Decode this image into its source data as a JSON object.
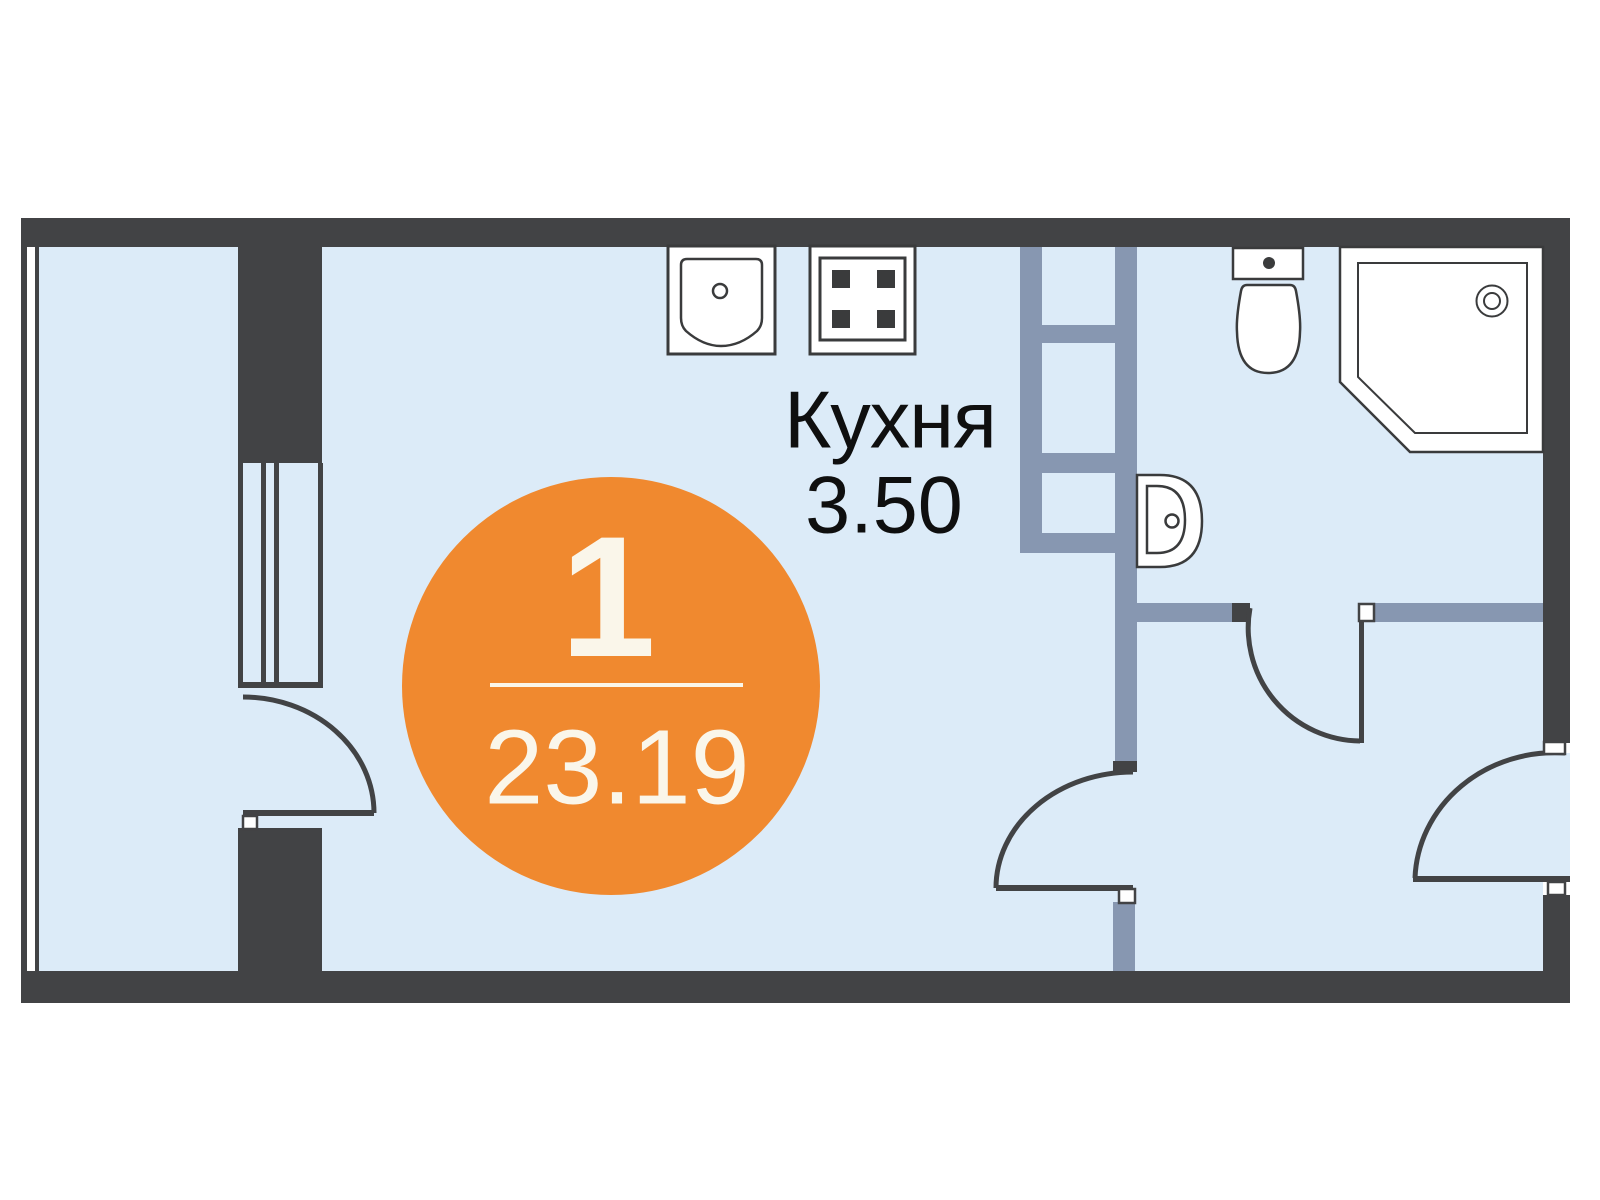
{
  "document": {
    "type": "apartment floor plan",
    "language": "ru"
  },
  "badge": {
    "rooms_count": "1",
    "total_area": "23.19"
  },
  "kitchen": {
    "label": "Кухня",
    "area": "3.50"
  },
  "colors": {
    "wall_dark": "#424345",
    "floor_fill": "#dcebf8",
    "partition_gray": "#8797b1",
    "fixture_fill": "#ffffff",
    "fixture_outline": "#3a3b3c",
    "badge_orange": "#f0892f",
    "badge_text": "#faf6ea",
    "label_text": "#0f0f0f",
    "page_background": "#ffffff"
  },
  "icons": [
    "kitchen-sink-icon",
    "cooktop-icon",
    "toilet-icon",
    "washbasin-icon",
    "shower-cabin-icon",
    "wardrobe-shelves-icon",
    "balcony-window-icon",
    "partition-window-icon",
    "door-swing-arc-icon"
  ]
}
